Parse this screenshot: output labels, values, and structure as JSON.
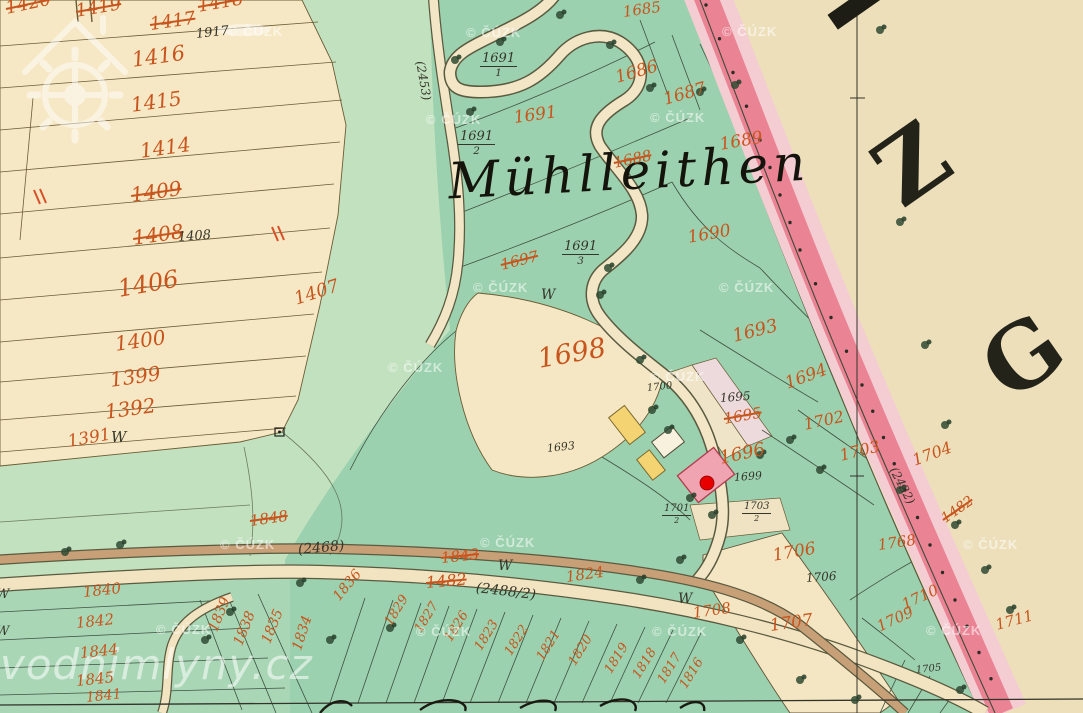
{
  "map": {
    "place_label": "Mühlleithen",
    "sheet_letters": [
      {
        "ch": "Z"
      },
      {
        "ch": "G"
      }
    ],
    "watermarks": {
      "cuzk_text": "© ČÚZK",
      "brand_text": "vodnimlyny.cz"
    },
    "w_mark": "W",
    "marker": {
      "name": "watermill-location",
      "color": "#e80000"
    },
    "colors": {
      "parchment": "#ecdfba",
      "field_cream": "#f6e8c4",
      "meadow_green": "#c2e1bf",
      "forest_green": "#9bd1ae",
      "band_pink": "#ea8494",
      "band_pink_light": "#f4cdd2",
      "number_orange": "#c8551e",
      "ink_black": "#35352a",
      "building_pink": "#f0a3b1",
      "building_yellow": "#f3d372",
      "marker_red": "#e80000"
    },
    "labels": [
      {
        "t": "1420",
        "x": 6,
        "y": 0,
        "s": 18,
        "r": -12,
        "c": "o x"
      },
      {
        "t": "1419",
        "x": 76,
        "y": 3,
        "s": 18,
        "r": -10,
        "c": "o x"
      },
      {
        "t": "1418",
        "x": 198,
        "y": -2,
        "s": 18,
        "r": -10,
        "c": "o x"
      },
      {
        "t": "1417",
        "x": 150,
        "y": 16,
        "s": 18,
        "r": -8,
        "c": "o x"
      },
      {
        "t": "1416",
        "x": 132,
        "y": 50,
        "s": 21,
        "r": -8,
        "c": "o"
      },
      {
        "t": "1415",
        "x": 131,
        "y": 95,
        "s": 20,
        "r": -8,
        "c": "o"
      },
      {
        "t": "1414",
        "x": 140,
        "y": 141,
        "s": 20,
        "r": -8,
        "c": "o"
      },
      {
        "t": "1409",
        "x": 131,
        "y": 185,
        "s": 20,
        "r": -8,
        "c": "o x"
      },
      {
        "t": "1408",
        "x": 133,
        "y": 228,
        "s": 20,
        "r": -8,
        "c": "o x"
      },
      {
        "t": "1406",
        "x": 118,
        "y": 277,
        "s": 24,
        "r": -10,
        "c": "o"
      },
      {
        "t": "1407",
        "x": 295,
        "y": 291,
        "s": 18,
        "r": -18,
        "c": "o"
      },
      {
        "t": "1400",
        "x": 115,
        "y": 334,
        "s": 20,
        "r": -8,
        "c": "o"
      },
      {
        "t": "1399",
        "x": 110,
        "y": 370,
        "s": 20,
        "r": -8,
        "c": "o"
      },
      {
        "t": "1392",
        "x": 105,
        "y": 402,
        "s": 20,
        "r": -8,
        "c": "o"
      },
      {
        "t": "1391",
        "x": 68,
        "y": 434,
        "s": 17,
        "r": -10,
        "c": "o"
      },
      {
        "t": "1685",
        "x": 623,
        "y": 5,
        "s": 15,
        "r": -8,
        "c": "o"
      },
      {
        "t": "1686",
        "x": 616,
        "y": 70,
        "s": 17,
        "r": -16,
        "c": "o"
      },
      {
        "t": "1687",
        "x": 664,
        "y": 92,
        "s": 17,
        "r": -16,
        "c": "o"
      },
      {
        "t": "1689",
        "x": 720,
        "y": 137,
        "s": 17,
        "r": -10,
        "c": "o"
      },
      {
        "t": "1688",
        "x": 614,
        "y": 156,
        "s": 15,
        "r": -12,
        "c": "o x"
      },
      {
        "t": "1690",
        "x": 688,
        "y": 230,
        "s": 17,
        "r": -10,
        "c": "o"
      },
      {
        "t": "1691",
        "x": 514,
        "y": 110,
        "s": 17,
        "r": -8,
        "c": "o"
      },
      {
        "t": "1697",
        "x": 501,
        "y": 258,
        "s": 15,
        "r": -14,
        "c": "o x"
      },
      {
        "t": "1698",
        "x": 538,
        "y": 346,
        "s": 27,
        "r": -10,
        "c": "o"
      },
      {
        "t": "1693",
        "x": 733,
        "y": 328,
        "s": 18,
        "r": -14,
        "c": "o"
      },
      {
        "t": "1694",
        "x": 786,
        "y": 376,
        "s": 17,
        "r": -20,
        "c": "o"
      },
      {
        "t": "1695",
        "x": 724,
        "y": 412,
        "s": 15,
        "r": -10,
        "c": "o x"
      },
      {
        "t": "1696",
        "x": 720,
        "y": 450,
        "s": 18,
        "r": -12,
        "c": "o"
      },
      {
        "t": "1702",
        "x": 804,
        "y": 417,
        "s": 16,
        "r": -12,
        "c": "o"
      },
      {
        "t": "1703",
        "x": 840,
        "y": 448,
        "s": 16,
        "r": -14,
        "c": "o"
      },
      {
        "t": "1704",
        "x": 913,
        "y": 453,
        "s": 16,
        "r": -20,
        "c": "o"
      },
      {
        "t": "1482",
        "x": 943,
        "y": 513,
        "s": 14,
        "r": -35,
        "c": "o x"
      },
      {
        "t": "1768",
        "x": 878,
        "y": 538,
        "s": 15,
        "r": -8,
        "c": "o"
      },
      {
        "t": "1706",
        "x": 773,
        "y": 548,
        "s": 17,
        "r": -10,
        "c": "o"
      },
      {
        "t": "1708",
        "x": 693,
        "y": 606,
        "s": 15,
        "r": -8,
        "c": "o"
      },
      {
        "t": "1707",
        "x": 770,
        "y": 618,
        "s": 17,
        "r": -8,
        "c": "o"
      },
      {
        "t": "1710",
        "x": 903,
        "y": 598,
        "s": 15,
        "r": -25,
        "c": "o"
      },
      {
        "t": "1709",
        "x": 878,
        "y": 620,
        "s": 15,
        "r": -25,
        "c": "o"
      },
      {
        "t": "1711",
        "x": 996,
        "y": 618,
        "s": 15,
        "r": -15,
        "c": "o"
      },
      {
        "t": "1848",
        "x": 250,
        "y": 514,
        "s": 15,
        "r": -8,
        "c": "o x"
      },
      {
        "t": "1843",
        "x": 441,
        "y": 551,
        "s": 15,
        "r": -6,
        "c": "o x"
      },
      {
        "t": "1482",
        "x": 426,
        "y": 575,
        "s": 16,
        "r": -5,
        "c": "o x"
      },
      {
        "t": "1824",
        "x": 566,
        "y": 570,
        "s": 15,
        "r": -8,
        "c": "o"
      },
      {
        "t": "1836",
        "x": 336,
        "y": 592,
        "s": 14,
        "r": -50,
        "c": "o"
      },
      {
        "t": "1840",
        "x": 83,
        "y": 585,
        "s": 15,
        "r": -6,
        "c": "o"
      },
      {
        "t": "1842",
        "x": 76,
        "y": 616,
        "s": 15,
        "r": -6,
        "c": "o"
      },
      {
        "t": "1844",
        "x": 80,
        "y": 646,
        "s": 15,
        "r": -6,
        "c": "o"
      },
      {
        "t": "1845",
        "x": 76,
        "y": 674,
        "s": 15,
        "r": -6,
        "c": "o"
      },
      {
        "t": "1841",
        "x": 86,
        "y": 691,
        "s": 14,
        "r": -6,
        "c": "o"
      },
      {
        "t": "1839",
        "x": 213,
        "y": 624,
        "s": 14,
        "r": -68,
        "c": "o"
      },
      {
        "t": "1838",
        "x": 238,
        "y": 638,
        "s": 14,
        "r": -68,
        "c": "o"
      },
      {
        "t": "1835",
        "x": 266,
        "y": 636,
        "s": 14,
        "r": -68,
        "c": "o"
      },
      {
        "t": "1834",
        "x": 297,
        "y": 643,
        "s": 14,
        "r": -72,
        "c": "o"
      },
      {
        "t": "1829",
        "x": 388,
        "y": 618,
        "s": 13,
        "r": -58,
        "c": "o"
      },
      {
        "t": "1827",
        "x": 418,
        "y": 625,
        "s": 13,
        "r": -58,
        "c": "o"
      },
      {
        "t": "1826",
        "x": 448,
        "y": 634,
        "s": 13,
        "r": -58,
        "c": "o"
      },
      {
        "t": "1823",
        "x": 478,
        "y": 643,
        "s": 13,
        "r": -58,
        "c": "o"
      },
      {
        "t": "1822",
        "x": 508,
        "y": 648,
        "s": 13,
        "r": -58,
        "c": "o"
      },
      {
        "t": "1821",
        "x": 540,
        "y": 653,
        "s": 13,
        "r": -58,
        "c": "o"
      },
      {
        "t": "1820",
        "x": 572,
        "y": 658,
        "s": 13,
        "r": -58,
        "c": "o"
      },
      {
        "t": "1819",
        "x": 608,
        "y": 666,
        "s": 13,
        "r": -58,
        "c": "o"
      },
      {
        "t": "1818",
        "x": 636,
        "y": 671,
        "s": 13,
        "r": -58,
        "c": "o"
      },
      {
        "t": "1817",
        "x": 661,
        "y": 676,
        "s": 13,
        "r": -58,
        "c": "o"
      },
      {
        "t": "1816",
        "x": 683,
        "y": 681,
        "s": 13,
        "r": -58,
        "c": "o"
      },
      {
        "t": "1917",
        "x": 196,
        "y": 28,
        "s": 13,
        "r": -6,
        "c": "b"
      },
      {
        "t": "1408",
        "x": 178,
        "y": 231,
        "s": 13,
        "r": -4,
        "c": "b"
      },
      {
        "t": "1693",
        "x": 547,
        "y": 443,
        "s": 11,
        "r": -6,
        "c": "b"
      },
      {
        "t": "1695",
        "x": 720,
        "y": 392,
        "s": 12,
        "r": -4,
        "c": "b"
      },
      {
        "t": "1700",
        "x": 647,
        "y": 384,
        "s": 10,
        "r": -6,
        "c": "b"
      },
      {
        "t": "1699",
        "x": 734,
        "y": 472,
        "s": 11,
        "r": -4,
        "c": "b"
      },
      {
        "t": "1706",
        "x": 806,
        "y": 572,
        "s": 12,
        "r": -4,
        "c": "b"
      },
      {
        "t": "1705",
        "x": 916,
        "y": 666,
        "s": 10,
        "r": -6,
        "c": "b"
      },
      {
        "t": "(2453)",
        "x": 420,
        "y": 55,
        "s": 12,
        "r": 80,
        "c": "b"
      },
      {
        "t": "(2468)",
        "x": 298,
        "y": 543,
        "s": 14,
        "r": -5,
        "c": "b"
      },
      {
        "t": "(2488/2)",
        "x": 476,
        "y": 581,
        "s": 14,
        "r": 7,
        "c": "b"
      },
      {
        "t": "(2432)",
        "x": 893,
        "y": 462,
        "s": 12,
        "r": 62,
        "c": "b"
      },
      {
        "n": "1691",
        "d": "1",
        "x": 480,
        "y": 52,
        "s": 13,
        "c": "b"
      },
      {
        "n": "1691",
        "d": "2",
        "x": 458,
        "y": 130,
        "s": 13,
        "c": "b"
      },
      {
        "n": "1691",
        "d": "3",
        "x": 562,
        "y": 240,
        "s": 13,
        "c": "b"
      },
      {
        "n": "1701",
        "d": "2",
        "x": 662,
        "y": 504,
        "s": 10,
        "c": "b"
      },
      {
        "n": "1703",
        "d": "2",
        "x": 742,
        "y": 502,
        "s": 10,
        "c": "b"
      }
    ],
    "w_marks": [
      {
        "x": 111,
        "y": 430,
        "s": 15
      },
      {
        "x": 541,
        "y": 288,
        "s": 14
      },
      {
        "x": 498,
        "y": 559,
        "s": 14
      },
      {
        "x": 678,
        "y": 592,
        "s": 14
      },
      {
        "x": -4,
        "y": 588,
        "s": 13
      },
      {
        "x": -4,
        "y": 625,
        "s": 13
      }
    ],
    "cuzk_positions": [
      {
        "x": 228,
        "y": 24
      },
      {
        "x": 466,
        "y": 25
      },
      {
        "x": 722,
        "y": 24
      },
      {
        "x": 426,
        "y": 112
      },
      {
        "x": 650,
        "y": 110
      },
      {
        "x": 473,
        "y": 280
      },
      {
        "x": 719,
        "y": 280
      },
      {
        "x": 388,
        "y": 360
      },
      {
        "x": 650,
        "y": 369
      },
      {
        "x": 220,
        "y": 537
      },
      {
        "x": 480,
        "y": 535
      },
      {
        "x": 963,
        "y": 537
      },
      {
        "x": 156,
        "y": 622
      },
      {
        "x": 416,
        "y": 624
      },
      {
        "x": 652,
        "y": 624
      },
      {
        "x": 926,
        "y": 623
      }
    ],
    "tree_symbols": [
      {
        "x": 455,
        "y": 60
      },
      {
        "x": 470,
        "y": 112
      },
      {
        "x": 500,
        "y": 42
      },
      {
        "x": 560,
        "y": 15
      },
      {
        "x": 610,
        "y": 45
      },
      {
        "x": 650,
        "y": 88
      },
      {
        "x": 700,
        "y": 92
      },
      {
        "x": 735,
        "y": 85
      },
      {
        "x": 608,
        "y": 268
      },
      {
        "x": 600,
        "y": 295
      },
      {
        "x": 640,
        "y": 360
      },
      {
        "x": 652,
        "y": 410
      },
      {
        "x": 668,
        "y": 430
      },
      {
        "x": 690,
        "y": 498
      },
      {
        "x": 712,
        "y": 515
      },
      {
        "x": 760,
        "y": 455
      },
      {
        "x": 790,
        "y": 440
      },
      {
        "x": 820,
        "y": 470
      },
      {
        "x": 880,
        "y": 30
      },
      {
        "x": 900,
        "y": 222
      },
      {
        "x": 925,
        "y": 345
      },
      {
        "x": 945,
        "y": 425
      },
      {
        "x": 900,
        "y": 490
      },
      {
        "x": 955,
        "y": 525
      },
      {
        "x": 985,
        "y": 570
      },
      {
        "x": 1010,
        "y": 610
      },
      {
        "x": 390,
        "y": 628
      },
      {
        "x": 330,
        "y": 640
      },
      {
        "x": 300,
        "y": 583
      },
      {
        "x": 230,
        "y": 612
      },
      {
        "x": 205,
        "y": 640
      },
      {
        "x": 120,
        "y": 545
      },
      {
        "x": 65,
        "y": 552
      },
      {
        "x": 740,
        "y": 640
      },
      {
        "x": 800,
        "y": 680
      },
      {
        "x": 855,
        "y": 700
      },
      {
        "x": 960,
        "y": 690
      },
      {
        "x": 680,
        "y": 560
      },
      {
        "x": 640,
        "y": 580
      }
    ]
  }
}
